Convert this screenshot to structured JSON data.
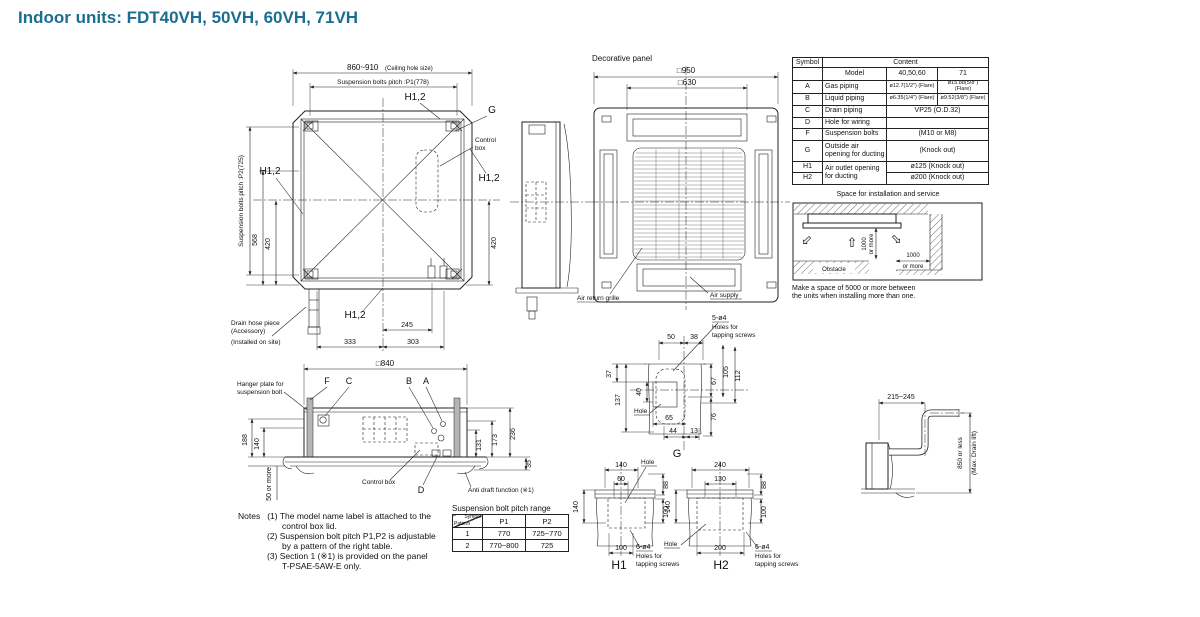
{
  "title": "Indoor units: FDT40VH, 50VH, 60VH, 71VH",
  "colors": {
    "accent": "#1b6e91",
    "line": "#222222"
  },
  "icons": {
    "airflow_arrow": "⇧"
  },
  "common": {
    "h12": "H1,2",
    "hole": "Hole",
    "holes_for": "Holes for",
    "tapping": "tapping screws",
    "or_more": "or more",
    "k1000": "1000"
  },
  "plan": {
    "ceiling_hole": "860~910",
    "ceiling_note": "(Ceiling hole size)",
    "p1": "Suspension bolts pitch :P1(778)",
    "p2": "Suspension bolts pitch :P2(725)",
    "g": "G",
    "control_l1": "Control",
    "control_l2": "box",
    "d568": "568",
    "d420": "420",
    "d245": "245",
    "d333": "333",
    "d303": "303",
    "drain1": "Drain hose piece",
    "drain2": "(Accessory)",
    "drain3": "(Installed on site)"
  },
  "panel": {
    "label": "Decorative panel",
    "d950": "□950",
    "d630": "□630",
    "air_return": "Air return grille",
    "air_supply": "Air supply"
  },
  "spec": {
    "symbol": "Symbol",
    "content": "Content",
    "model": "Model",
    "m1": "40,50,60",
    "m2": "71",
    "rows": [
      {
        "s": "A",
        "n": "Gas piping",
        "v1": "ø12.7(1/2\") (Flare)",
        "v2": "ø15.88(5/8\") (Flare)"
      },
      {
        "s": "B",
        "n": "Liquid piping",
        "v1": "ø6.35(1/4\") (Flare)",
        "v2": "ø9.52(3/8\") (Flare)"
      },
      {
        "s": "C",
        "n": "Drain piping",
        "v": "VP25 (O.D.32)"
      },
      {
        "s": "D",
        "n": "Hole for wiring",
        "v": ""
      },
      {
        "s": "F",
        "n": "Suspension bolts",
        "v": "(M10 or M8)"
      },
      {
        "s": "G",
        "n": "Outside air opening for ducting",
        "v": "(Knock out)"
      },
      {
        "s": "H1",
        "n": "Air outlet opening for ducting",
        "v": "ø125 (Knock out)"
      },
      {
        "s": "H2",
        "v": "ø200 (Knock out)"
      }
    ]
  },
  "space": {
    "title": "Space for installation and service",
    "obstacle": "Obstacle",
    "note1": "Make a space of 5000 or more between",
    "note2": "the units when installing more than one."
  },
  "section": {
    "d840": "□840",
    "hanger1": "Hanger plate for",
    "hanger2": "suspension bolt",
    "f": "F",
    "c": "C",
    "b": "B",
    "a": "A",
    "dd": "D",
    "d188": "188",
    "d140": "140",
    "d50": "50 or more",
    "d131": "131",
    "d173": "173",
    "d236": "236",
    "d35": "35",
    "control_box": "Control box",
    "anti_draft": "Anti draft function (※1)"
  },
  "notes": {
    "label": "Notes",
    "n1a": "(1) The model name label is attached to the",
    "n1b": "control box lid.",
    "n2a": "(2) Suspension bolt pitch P1,P2 is adjustable",
    "n2b": "by a pattern of the right table.",
    "n3a": "(3) Section 1 (※1) is provided on the panel",
    "n3b": "T-PSAE-5AW-E only."
  },
  "pitch": {
    "title": "Suspension bolt pitch range",
    "corner_top": "Symbol",
    "corner_bottom": "Pattern",
    "p1": "P1",
    "p2": "P2",
    "rows": [
      {
        "pat": "1",
        "p1": "770",
        "p2": "725~770"
      },
      {
        "pat": "2",
        "p1": "770~800",
        "p2": "725"
      }
    ]
  },
  "gdet": {
    "n": "5-ø4",
    "d50": "50",
    "d38": "38",
    "d37": "37",
    "d137": "137",
    "d40": "40",
    "d67": "67",
    "d105": "105",
    "d112": "112",
    "d76": "76",
    "d65": "65",
    "d44": "44",
    "d13": "13",
    "label": "G"
  },
  "h1det": {
    "t140": "140",
    "t60": "60",
    "d88": "88",
    "l140": "140",
    "r100": "100",
    "b100": "100",
    "n": "6-ø4",
    "label": "H1"
  },
  "h2det": {
    "t240": "240",
    "t130": "130",
    "d88": "88",
    "l140": "140",
    "r100": "100",
    "b200": "200",
    "n": "6-ø4",
    "label": "H2"
  },
  "drain": {
    "d215": "215~245",
    "lift1": "850 or less",
    "lift2": "(Max. Drain lift)"
  }
}
